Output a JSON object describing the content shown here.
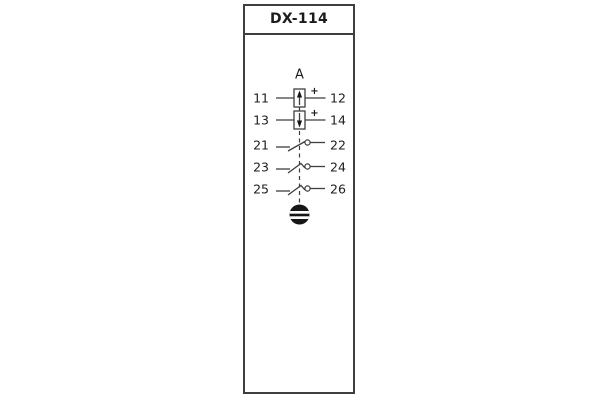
{
  "header": {
    "title": "DX-114"
  },
  "diagram": {
    "device_label": "A",
    "rows": [
      {
        "left": "11",
        "right": "12",
        "element": "polarized-element-arrow-up-icon",
        "polarity": "+"
      },
      {
        "left": "13",
        "right": "14",
        "element": "polarized-element-arrow-down-icon",
        "polarity": "+"
      },
      {
        "left": "21",
        "right": "22",
        "element": "make-contact-icon"
      },
      {
        "left": "23",
        "right": "24",
        "element": "latching-make-contact-icon"
      },
      {
        "left": "25",
        "right": "26",
        "element": "latching-make-contact-icon"
      }
    ],
    "reset_button_icon": "manual-reset-button-icon",
    "linkage_icon": "mechanical-linkage-dashed-line"
  },
  "colors": {
    "line": "#3e3e3e",
    "text": "#1c1c1c",
    "panel_background": "#ffffff",
    "reset_button_fill": "#161616"
  }
}
